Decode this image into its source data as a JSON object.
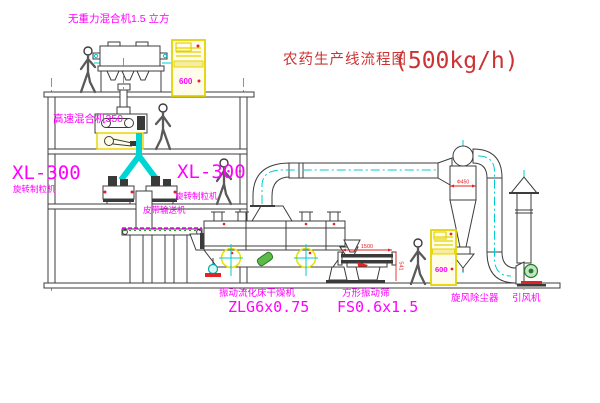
{
  "title": {
    "name": "农药生产线流程图",
    "capacity": "(500kg/h)"
  },
  "labels": {
    "gravity_mixer": "无重力混合机1.5 立方",
    "high_speed_mixer": "高速混合机350",
    "xl300_left_model": "XL-300",
    "xl300_left_name": "旋转制粒机",
    "xl300_mid_model": "XL-300",
    "xl300_mid_name": "旋转制粒机",
    "belt_conveyor": "皮带输送机",
    "dryer_name": "振动流化床干燥机",
    "dryer_model": "ZLG6x0.75",
    "screen_name": "方形振动筛",
    "screen_model": "FS0.6x1.5",
    "cyclone_name": "旋风除尘器",
    "fan_name": "引风机"
  },
  "dimensions": {
    "screen_length": "1500",
    "screen_height": "541",
    "cyclone_diameter": "Φ450"
  },
  "cabinets": {
    "display": "600"
  },
  "figures": {
    "count": 4
  },
  "colors": {
    "background": "#ffffff",
    "label_magenta": "#ff00ff",
    "title_red": "#cd3333",
    "dimension_red": "#e32222",
    "pipe_cyan": "#00d5d5",
    "cabinet_yellow": "#e4d400",
    "line_dark": "#3c3c3c"
  }
}
